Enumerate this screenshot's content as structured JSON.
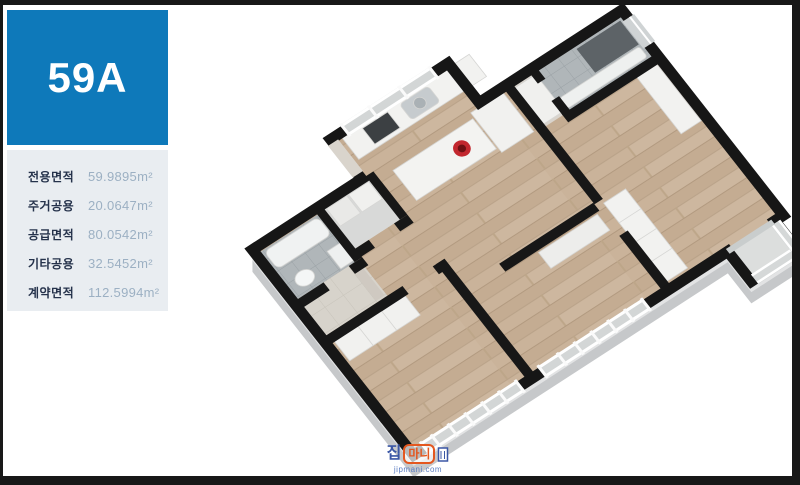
{
  "unit": {
    "label": "59A"
  },
  "area_table": {
    "rows": [
      {
        "label": "전용면적",
        "value": "59.9895m²"
      },
      {
        "label": "주거공용",
        "value": "20.0647m²"
      },
      {
        "label": "공급면적",
        "value": "80.0542m²"
      },
      {
        "label": "기타공용",
        "value": "32.5452m²"
      },
      {
        "label": "계약면적",
        "value": "112.5994m²"
      }
    ]
  },
  "watermark": {
    "logo_left": "집",
    "logo_right": "마니",
    "url": "jipmani.com"
  },
  "colors": {
    "accent-blue": "#0e79ba",
    "panel-bg": "#e9edf1",
    "label-text": "#25324b",
    "value-text": "#9cb0c3",
    "frame-black": "#181818",
    "wm-blue": "#3b57a5",
    "wm-orange": "#e4571f"
  }
}
